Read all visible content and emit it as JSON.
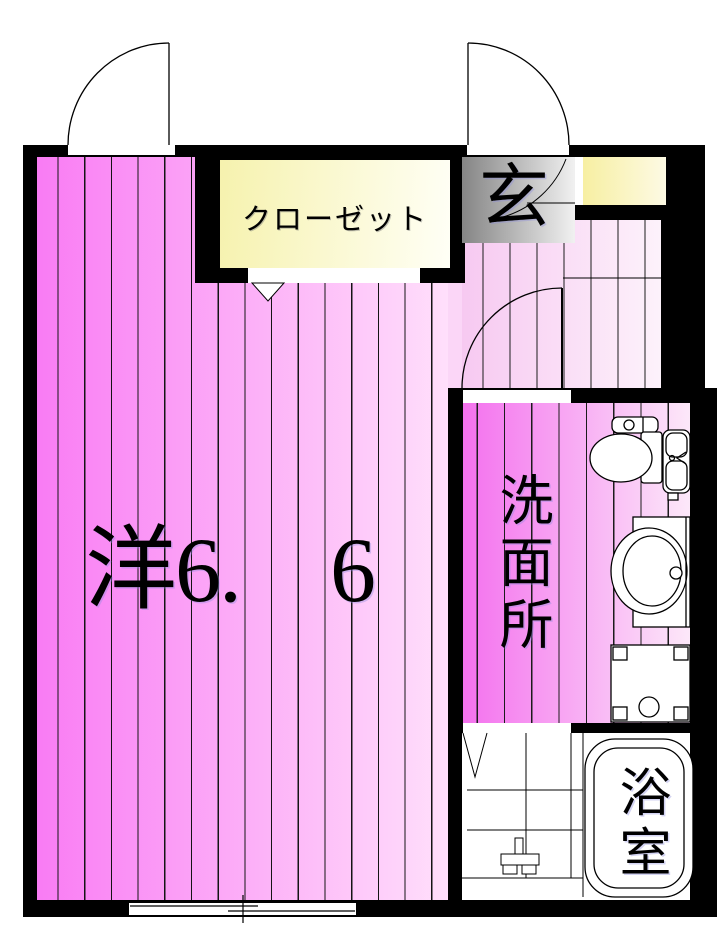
{
  "floorplan": {
    "type": "japanese-apartment-floor-plan",
    "rooms": {
      "main": {
        "label": "洋6.　6",
        "meaning": "western-style room 6.6 mats"
      },
      "closet": {
        "label": "クローゼット"
      },
      "entrance": {
        "label": "玄"
      },
      "washroom": {
        "label": "洗面所"
      },
      "bathroom": {
        "label": "浴室"
      }
    },
    "colors": {
      "wall": "#000000",
      "main_room_gradient_left": "#f97cf4",
      "main_room_gradient_right": "#ffdffb",
      "hallway_gradient_left": "#f7c9f1",
      "hallway_gradient_right": "#fdf2fb",
      "washroom_gradient_left": "#f471ee",
      "washroom_gradient_right": "#fce8f9",
      "closet_gradient_left": "#f6f2ae",
      "closet_gradient_right": "#fffff6",
      "shoe_cabinet_gradient_left": "#f7efa2",
      "shoe_cabinet_gradient_right": "#fdfae4",
      "entrance_floor_dark": "#858585",
      "entrance_floor_light": "#f1f1f1",
      "background": "#ffffff"
    },
    "fixtures": [
      "toilet-icon",
      "vanity-sink-icon",
      "washing-machine-pan-icon",
      "bathtub-icon",
      "shower-faucet-icon",
      "tiled-floor-icon"
    ],
    "openings": [
      "hinged-door-top-left-icon",
      "hinged-entrance-door-icon",
      "entrance-inner-door-swing-icon",
      "washroom-door-swing-icon",
      "closet-folding-door-icon",
      "bathroom-folding-door-icon",
      "sliding-window-icon"
    ]
  }
}
